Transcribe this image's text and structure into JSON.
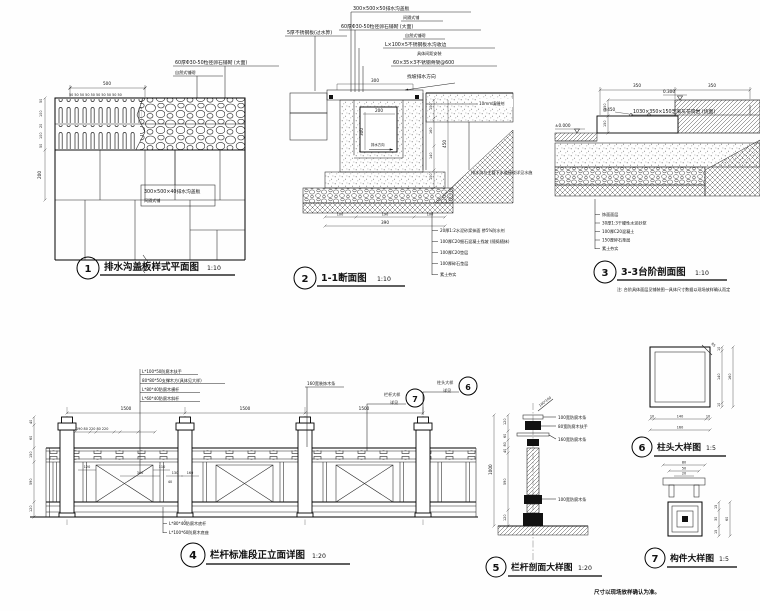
{
  "footer": {
    "note": "尺寸以现场放样确认为准。"
  },
  "d1": {
    "num": "1",
    "title": "排水沟盖板样式平面图",
    "scale": "1:10",
    "lbl_pebble1": "60厚Φ30-50粒径卵石铺砌 (大面)",
    "lbl_pebble2": "自然式铺砌",
    "lbl_cover1": "300×500×40排水沟盖板",
    "lbl_cover2": "间隔式铺",
    "dim_500": "500",
    "dim_50row": "50 50 50 50 50 50 50 50 50 50",
    "dims_left": [
      "50",
      "100",
      "20",
      "100",
      "50"
    ],
    "dim_200": "200"
  },
  "d2": {
    "num": "2",
    "title": "1-1断面图",
    "scale": "1:10",
    "lbl_cover1": "300×500×50排水沟盖板",
    "lbl_cover2": "间隔式铺",
    "lbl_pebble1": "60厚Φ30-50粒径卵石铺砌 (大面)",
    "lbl_pebble2": "自然式铺砌",
    "lbl_steel_edge1": "L×100×5不锈钢板水沟收边",
    "lbl_steel_edge2": "具体间距安装",
    "lbl_frame": "60×35×3不锈钢骨架@600",
    "lbl_slope": "找坡排水方向",
    "lbl_grate": "5厚不锈钢板(过水箅)",
    "lbl_joint": "10mm填缝剂",
    "lbl_connect": "排水沟与主管下水道接驳详见水施",
    "lbl_flow": "排水方向",
    "dim_300": "300",
    "dim_200": "200",
    "dim_h300": "300",
    "dims_right": [
      "100",
      "160",
      "140",
      "100"
    ],
    "dim_450": "450",
    "dims_sub": [
      "100",
      "190",
      "100"
    ],
    "dim_390": "390",
    "notes": [
      "20厚1:2水泥砂浆抹面 掺5%防水剂",
      "100厚C20细石混凝土找坡 (随捣随抹)",
      "100厚C20垫层",
      "100厚碎石垫层",
      "素土夯实"
    ]
  },
  "d3": {
    "num": "3",
    "title": "3-3台阶剖面图",
    "scale": "1:10",
    "note": "注: 台阶具体面层见铺装图—具体尺寸数据以现场放样确认而定",
    "lbl_stone": "1030×350×150芝麻灰花岗岩 (烧面)",
    "lbl_450": "@450",
    "lv_300": "0.300",
    "lv_000": "±0.000",
    "dim_350a": "350",
    "dim_350b": "350",
    "dims_150": [
      "150",
      "150"
    ],
    "notes": [
      "饰面面层",
      "30厚1:3干硬性水泥砂浆",
      "100厚C20混凝土",
      "150厚碎石垫层",
      "素土夯实"
    ]
  },
  "d4": {
    "num": "4",
    "title": "栏杆标准段正立面详图",
    "scale": "1:20",
    "labels_top": [
      "L*100*50防腐木扶手",
      "80*80*50支撑木方(具体见大样)",
      "L*80*40防腐木横杆",
      "L*60*40防腐木斜杆"
    ],
    "lbl_strip": "160宽装饰木条",
    "c7_l1": "栏杆大样",
    "c7_l2": "详见",
    "c7_n": "7",
    "c6_l1": "柱头大样",
    "c6_l2": "详见",
    "c6_n": "6",
    "labels_bottom": [
      "L*80*40防腐木底杆",
      "L*100*60防腐木底座"
    ],
    "dims_1500": [
      "1500",
      "1500",
      "1500"
    ],
    "dim_row_top": "190 80 220 80 220",
    "dims_inner": [
      "120",
      "340",
      "110",
      "130",
      "160",
      "40"
    ],
    "dims_left": [
      "40",
      "60",
      "150",
      "590",
      "120"
    ]
  },
  "d5": {
    "num": "5",
    "title": "栏杆剖面大样图",
    "scale": "1:20",
    "lbl_post": "100*100",
    "labels_right": [
      "100宽防腐木条",
      "80宽防腐木扶手",
      "160宽防腐木条",
      "100宽防腐木条"
    ],
    "dims_left": [
      "120",
      "60",
      "80",
      "40",
      "590",
      "120"
    ],
    "dim_total": "1000"
  },
  "d6": {
    "num": "6",
    "title": "柱头大样图",
    "scale": "1:5",
    "lbl_r": "R5",
    "dims_right": [
      "10",
      "140",
      "10"
    ],
    "dim_right_total": "160",
    "dims_bottom": [
      "10",
      "140",
      "10"
    ],
    "dim_bottom_total": "160"
  },
  "d7": {
    "num": "7",
    "title": "构件大样图",
    "scale": "1:5",
    "dim_80": "80",
    "dim_50": "50",
    "dim_20": "20",
    "dims_right": [
      "15",
      "30",
      "15"
    ],
    "dim_total": "60"
  }
}
